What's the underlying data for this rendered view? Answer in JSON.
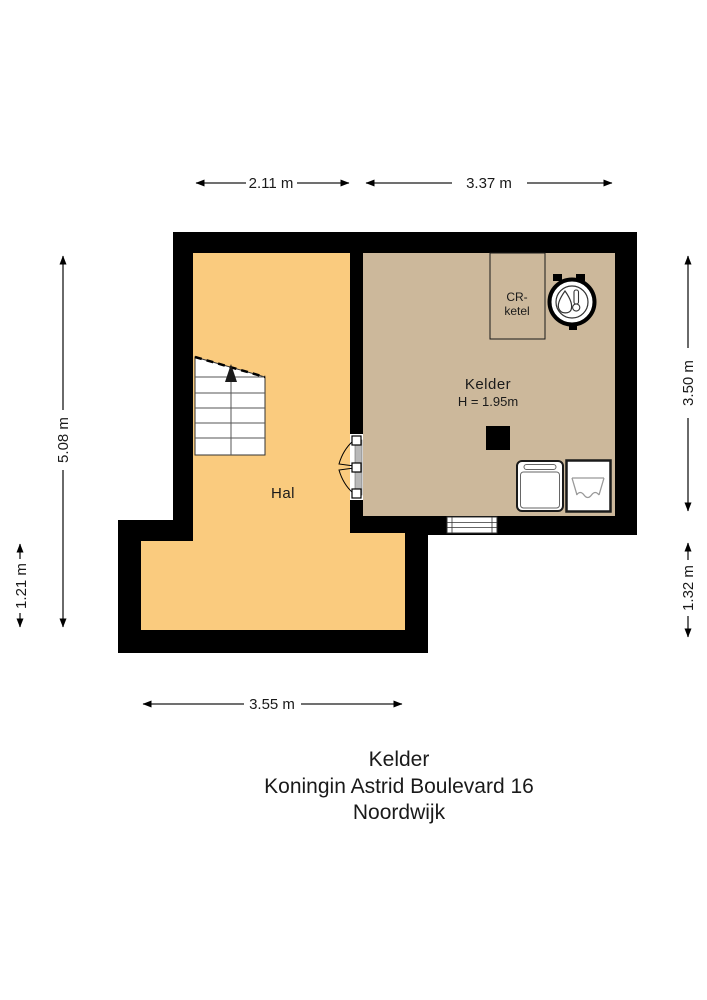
{
  "floor_plan": {
    "rooms": {
      "hal": {
        "label": "Hal"
      },
      "kelder": {
        "label": "Kelder",
        "ceiling_height": "H = 1.95m"
      }
    },
    "fixtures": {
      "cr_ketel": {
        "line1": "CR-",
        "line2": "ketel"
      },
      "icons": [
        "boiler-icon",
        "washing-machine-icon",
        "sink-icon",
        "stairs-icon",
        "double-door-icon",
        "window-icon",
        "chimney-duct"
      ]
    },
    "dimensions": {
      "top_left": "2.11 m",
      "top_right": "3.37 m",
      "left": "5.08 m",
      "left_lower": "1.21 m",
      "right": "3.50 m",
      "right_lower": "1.32 m",
      "bottom": "3.55 m"
    },
    "colors": {
      "hal": "#FACB7E",
      "kelder": "#CCB89B",
      "wall": "#000000",
      "line": "#1A1A1A"
    }
  },
  "title_block": {
    "floor": "Kelder",
    "address": "Koningin Astrid Boulevard 16",
    "city": "Noordwijk"
  }
}
